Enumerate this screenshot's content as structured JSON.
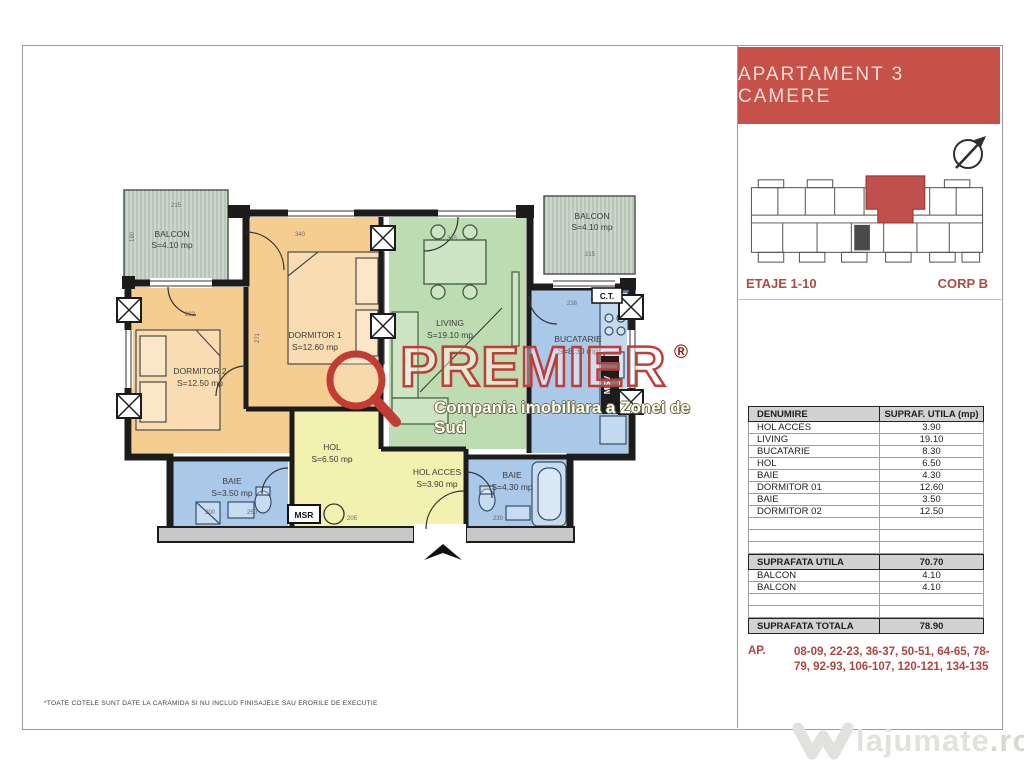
{
  "title": "APARTAMENT 3 CAMERE",
  "panel": {
    "etaje": "ETAJE 1-10",
    "corp": "CORP B",
    "table": {
      "header": {
        "name": "DENUMIRE",
        "area": "SUPRAF. UTILA (mp)"
      },
      "rows": [
        {
          "name": "HOL ACCES",
          "area": "3.90"
        },
        {
          "name": "LIVING",
          "area": "19.10"
        },
        {
          "name": "BUCATARIE",
          "area": "8.30"
        },
        {
          "name": "HOL",
          "area": "6.50"
        },
        {
          "name": "BAIE",
          "area": "4.30"
        },
        {
          "name": "DORMITOR 01",
          "area": "12.60"
        },
        {
          "name": "BAIE",
          "area": "3.50"
        },
        {
          "name": "DORMITOR 02",
          "area": "12.50"
        }
      ],
      "subtotal": {
        "name": "SUPRAFATA UTILA",
        "area": "70.70"
      },
      "balconies": [
        {
          "name": "BALCON",
          "area": "4.10"
        },
        {
          "name": "BALCON",
          "area": "4.10"
        }
      ],
      "total": {
        "name": "SUPRAFATA TOTALA",
        "area": "78.90"
      }
    },
    "ap_label": "AP.",
    "ap_numbers": "08-09, 22-23, 36-37, 50-51, 64-65, 78-79, 92-93, 106-107, 120-121, 134-135"
  },
  "plan": {
    "rooms": [
      {
        "name": "BALCON",
        "area": "S=4.10 mp"
      },
      {
        "name": "DORMITOR 2",
        "area": "S=12.50 mp"
      },
      {
        "name": "DORMITOR 1",
        "area": "S=12.60 mp"
      },
      {
        "name": "LIVING",
        "area": "S=19.10 mp"
      },
      {
        "name": "BALCON",
        "area": "S=4.10 mp"
      },
      {
        "name": "BUCATARIE",
        "area": "S=8.30 mp"
      },
      {
        "name": "HOL",
        "area": "S=6.50 mp"
      },
      {
        "name": "HOL ACCES",
        "area": "S=3.90 mp"
      },
      {
        "name": "BAIE",
        "area": "S=3.50 mp"
      },
      {
        "name": "BAIE",
        "area": "S=4.30 mp"
      }
    ],
    "tags": {
      "msr": "MSR",
      "msv": "MSV",
      "ct": "C.T."
    },
    "dims": [
      "215",
      "190",
      "340",
      "271",
      "282",
      "345",
      "215",
      "238",
      "205",
      "230",
      "250",
      "200"
    ]
  },
  "watermark": {
    "brand": "PREMIER",
    "reg": "®",
    "tagline": "Compania imobiliara a Zonei de Sud"
  },
  "footnote": "*TOATE COTELE SUNT DATE LA CARAMIDA SI NU INCLUD FINISAJELE SAU ERORILE DE EXECUTIE",
  "site": {
    "name": "lajumate",
    "tld": ".ro"
  },
  "colors": {
    "accent_red": "#c65148",
    "text_red": "#b04a44",
    "orange_room": "#f6cd90",
    "green_room": "#bedcb2",
    "blue_room": "#aac9e9",
    "yellow_room": "#f3f1b0",
    "hatch_room": "#cdd8cd",
    "table_header_bg": "#d2d2d2"
  }
}
